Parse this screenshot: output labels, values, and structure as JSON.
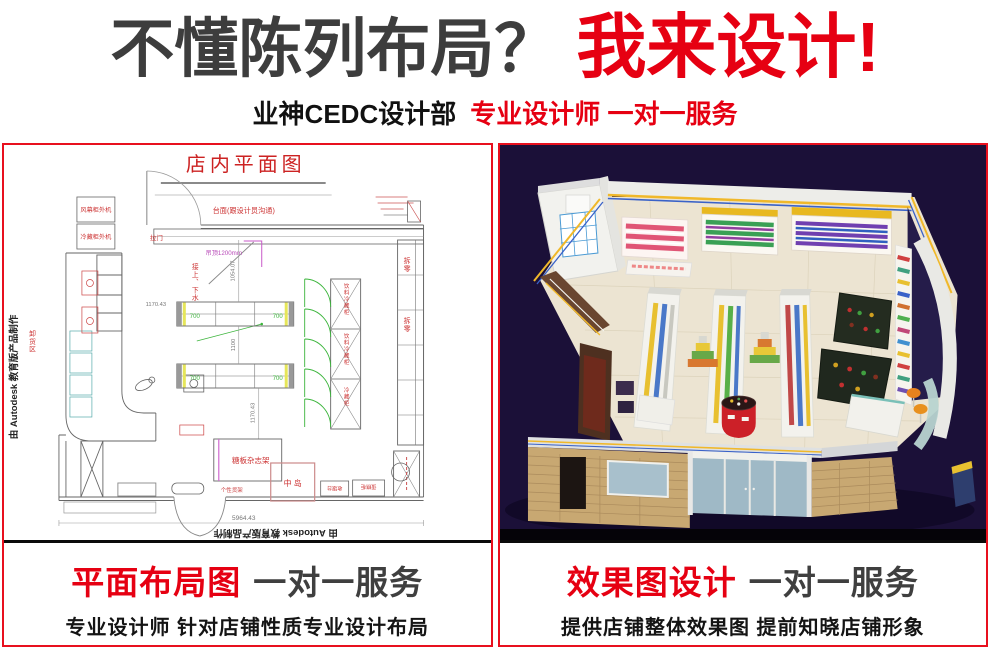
{
  "header": {
    "title_black": "不懂陈列布局？",
    "title_red": "我来设计!",
    "subtitle_black": "业神CEDC设计部",
    "subtitle_red": "专业设计师 一对一服务"
  },
  "left_panel": {
    "plan_title": "店内平面图",
    "labels": {
      "fan_unit": "风幕柜外机",
      "fridge_unit": "冷藏柜外机",
      "counter_note": "台面(跟设计员沟通)",
      "sliding_door": "拉门",
      "ceiling": "吊顶1200mm",
      "water": "接上、下水",
      "unload": "卸货区",
      "cooler": "饮料冷藏柜",
      "cooler2": "冷藏柜",
      "retail": "拆零",
      "magazine": "糖板杂志架",
      "shelf_note": "个性货架",
      "island": "中 岛",
      "cashier": "收银台",
      "cake": "蛋糕柜",
      "watermark": "由 Autodesk 教育版产品制作"
    },
    "dims": {
      "d700": "700",
      "d1054": "1054.07",
      "d1100": "1100",
      "d1170": "1170.43",
      "d5964": "5964.43"
    },
    "caption": {
      "highlight": "平面布局图",
      "rest": "一对一服务",
      "sub": "专业设计师 针对店铺性质专业设计布局"
    }
  },
  "right_panel": {
    "caption": {
      "highlight": "效果图设计",
      "rest": "一对一服务",
      "sub": "提供店铺整体效果图 提前知晓店铺形象"
    }
  },
  "colors": {
    "accent_red": "#e60012",
    "dark_text": "#3f3f3f",
    "plan_label_red": "#cc2222",
    "render_bg_navy": "#1b1038",
    "trim_yellow": "#f0b82a",
    "trim_blue": "#3a62c8"
  }
}
